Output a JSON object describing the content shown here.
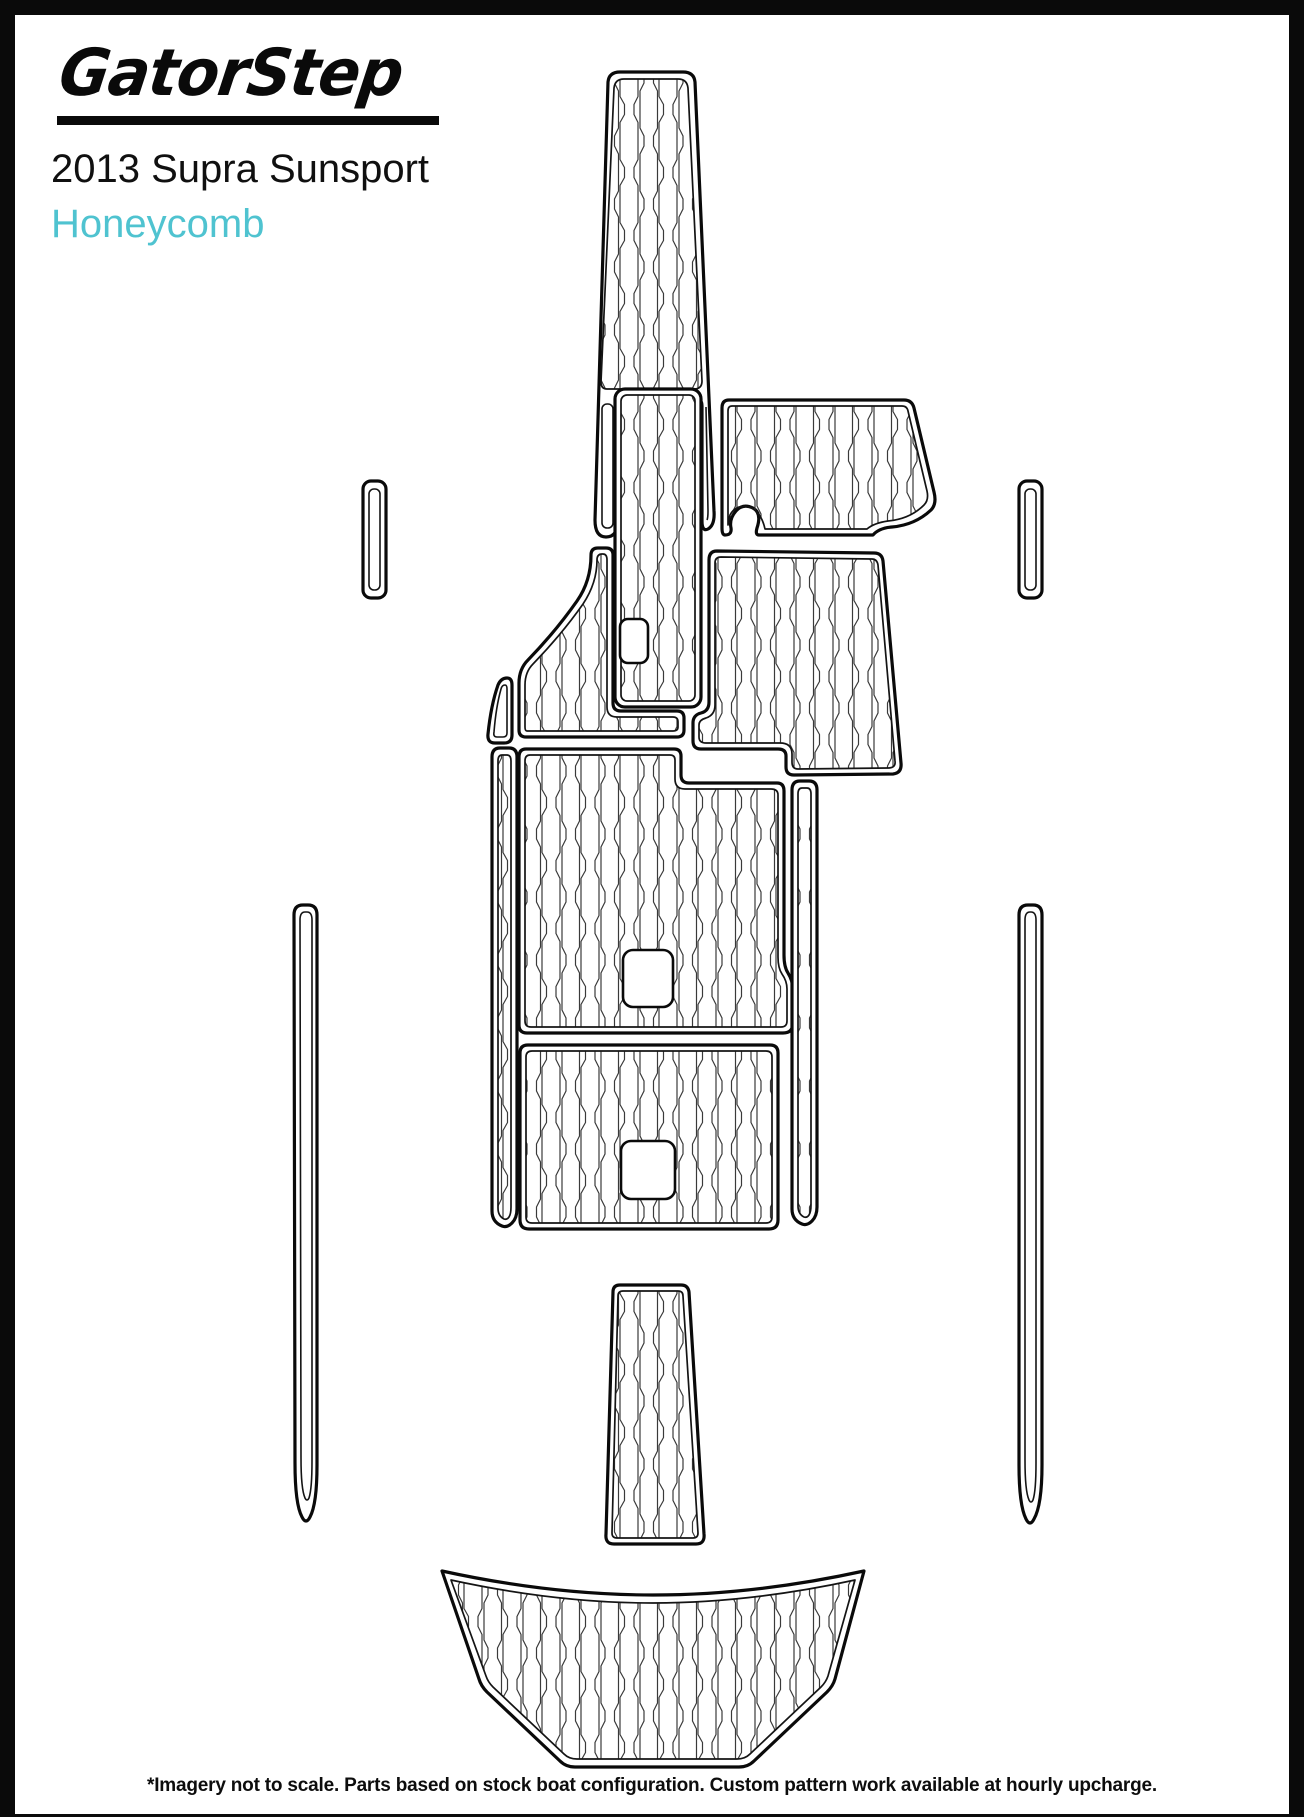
{
  "header": {
    "logo_text": "GatorStep",
    "title": "2013 Supra Sunsport",
    "subtitle": "Honeycomb"
  },
  "footer": {
    "disclaimer": "*Imagery not to scale. Parts based on stock boat configuration. Custom pattern work available at hourly upcharge."
  },
  "colors": {
    "accent": "#4FC3D0",
    "line": "#0A0A0A",
    "pattern_line": "#3A3A3A",
    "background": "#FFFFFF",
    "frame": "#0A0A0A"
  },
  "diagram": {
    "description": "Plan-view template of boat deck traction pads with honeycomb texture",
    "pattern_name": "honeycomb",
    "pieces": [
      "bow-runner-pad",
      "bow-step-pad",
      "starboard-bow-pad",
      "starboard-mid-pad",
      "upper-cockpit-pad",
      "cockpit-ear-pad",
      "side-pill-left",
      "side-pill-right",
      "cockpit-main-pad",
      "cockpit-runner-left",
      "cockpit-runner-right",
      "stern-sunpad",
      "gunwale-strip-left",
      "gunwale-strip-right",
      "transom-step-pad",
      "swim-platform-pad"
    ]
  }
}
